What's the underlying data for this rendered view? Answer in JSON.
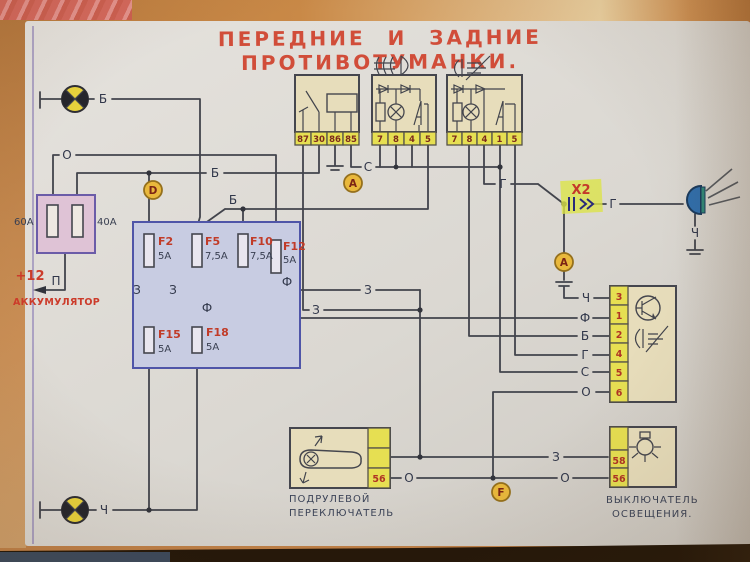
{
  "title": "ПЕРЕДНИЕ  И  ЗАДНИЕ  ПРОТИВОТУМАНКИ.",
  "battery": {
    "plus": "+12",
    "terminal": "П",
    "label": "АККУМУЛЯТОР",
    "fuse_left": "60А",
    "fuse_right": "40А"
  },
  "fusebox": {
    "fuses": [
      {
        "name": "F2",
        "rating": "5А"
      },
      {
        "name": "F5",
        "rating": "7,5А"
      },
      {
        "name": "F10",
        "rating": "7,5А"
      },
      {
        "name": "F12",
        "rating": "5А"
      },
      {
        "name": "F15",
        "rating": "5А"
      },
      {
        "name": "F18",
        "rating": "5А"
      }
    ]
  },
  "relay": {
    "terminals": [
      "87",
      "30",
      "86",
      "85"
    ]
  },
  "front_fog_unit": {
    "terminals": [
      "7",
      "8",
      "4",
      "5"
    ]
  },
  "rear_fog_unit": {
    "terminals": [
      "7",
      "8",
      "4",
      "1",
      "5"
    ]
  },
  "markers": {
    "d": "D",
    "a1": "А",
    "a2": "А",
    "f": "F"
  },
  "x2": "X2",
  "switch_block": {
    "terminals": [
      "3",
      "1",
      "2",
      "4",
      "5",
      "6"
    ],
    "wires": [
      "Ч",
      "Ф",
      "Б",
      "Г",
      "С",
      "О"
    ]
  },
  "column_switch": {
    "line1": "ПОДРУЛЕВОЙ",
    "line2": "ПЕРЕКЛЮЧАТЕЛЬ",
    "terminal": "56"
  },
  "light_switch": {
    "line1": "ВЫКЛЮЧАТЕЛЬ",
    "line2": "ОСВЕЩЕНИЯ.",
    "t58": "58",
    "t56": "56"
  },
  "wire_labels": {
    "b_top": "Б",
    "b_main": "Б",
    "b_branch": "Б",
    "o_feed": "О",
    "o_bot1": "О",
    "o_bot2": "О",
    "c_relay": "С",
    "z_left1": "З",
    "z_left2": "З",
    "z_mid": "З",
    "z_lower": "З",
    "z_bottom": "З",
    "f_f18": "Ф",
    "f_f12": "Ф",
    "g_left": "Г",
    "g_right": "Г",
    "ch_rear": "Ч",
    "ch_bottom": "Ч"
  }
}
